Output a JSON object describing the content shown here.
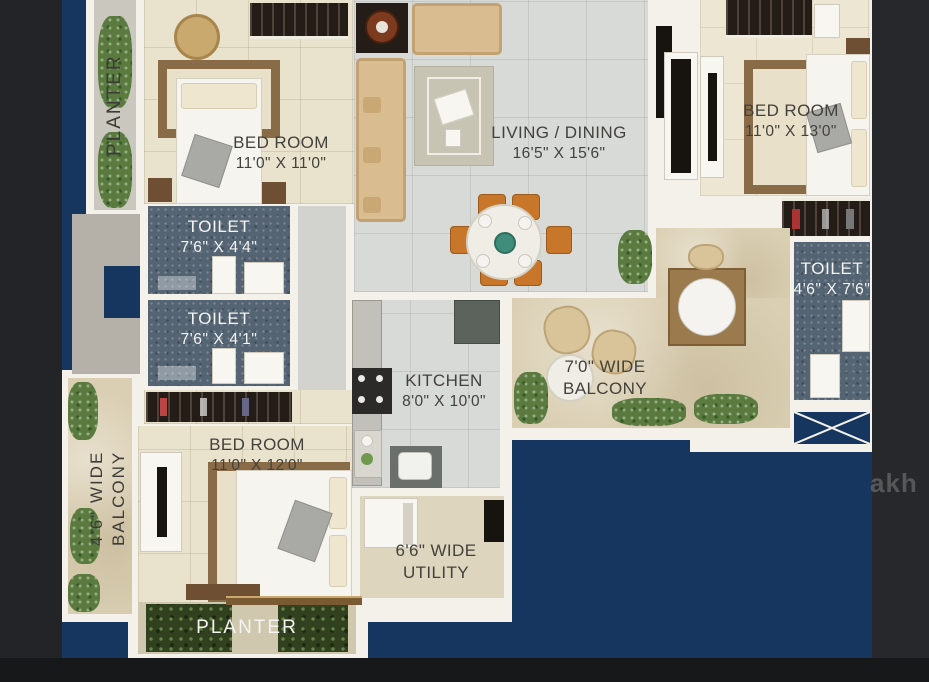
{
  "rooms": {
    "planter_left": {
      "label": "PLANTER"
    },
    "bedroom_tl": {
      "name": "BED ROOM",
      "dim": "11'0\" X 11'0\""
    },
    "living": {
      "name": "LIVING / DINING",
      "dim": "16'5\" X 15'6\""
    },
    "bedroom_tr": {
      "name": "BED ROOM",
      "dim": "11'0\" X 13'0\""
    },
    "toilet_top": {
      "name": "TOILET",
      "dim": "7'6\" X 4'4\""
    },
    "toilet_mid": {
      "name": "TOILET",
      "dim": "7'6\" X 4'1\""
    },
    "toilet_right": {
      "name": "TOILET",
      "dim": "4'6\" X 7'6\""
    },
    "kitchen": {
      "name": "KITCHEN",
      "dim": "8'0\" X 10'0\""
    },
    "balcony_right": {
      "line1": "7'0\" WIDE",
      "line2": "BALCONY"
    },
    "bedroom_bl": {
      "name": "BED ROOM",
      "dim": "11'0\" X 12'0\""
    },
    "balcony_left": {
      "line1": "4'6\" WIDE",
      "line2": "BALCONY"
    },
    "utility": {
      "line1": "6'6\" WIDE",
      "line2": "UTILITY"
    },
    "planter_bottom": {
      "label": "PLANTER"
    }
  },
  "watermark": "akh",
  "colors": {
    "backdrop_navy": "#17365f",
    "wall_white": "#f3f1ea",
    "toilet_floor": "#546473",
    "accent_orange": "#c8772a",
    "label_dark": "#42413c",
    "label_light": "#f4f4f2"
  }
}
